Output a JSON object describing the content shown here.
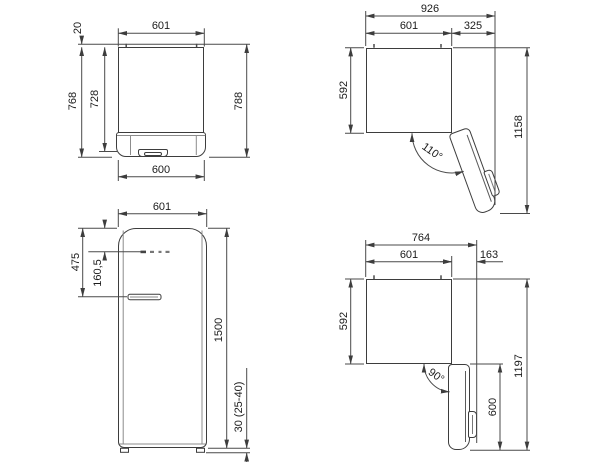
{
  "drawing": {
    "title": "refrigerator-dimension-drawing",
    "units": "mm",
    "line_color": "#3d3d3d",
    "text_color": "#1c1c1c",
    "views": {
      "top_closed": {
        "label": "top view, door closed",
        "dims": {
          "width_top": "601",
          "rear_gap": "20",
          "depth_body": "728",
          "depth_total": "768",
          "depth_with_handle": "788",
          "width_bottom": "600"
        }
      },
      "top_open_110": {
        "label": "top view, door open 110",
        "dims": {
          "total_width": "926",
          "body_width": "601",
          "door_swing": "325",
          "body_depth": "592",
          "total_depth": "1158",
          "angle": "110°"
        }
      },
      "front": {
        "label": "front view",
        "dims": {
          "width": "601",
          "handle_from_top": "475",
          "logo_from_top": "160,5",
          "height": "1500",
          "feet_height": "30 (25-40)"
        }
      },
      "top_open_90": {
        "label": "top view, door open 90",
        "dims": {
          "total_width": "764",
          "body_width": "601",
          "door_overhang": "163",
          "body_depth": "592",
          "door_depth": "600",
          "total_depth": "1197",
          "angle": "90°"
        }
      }
    }
  }
}
